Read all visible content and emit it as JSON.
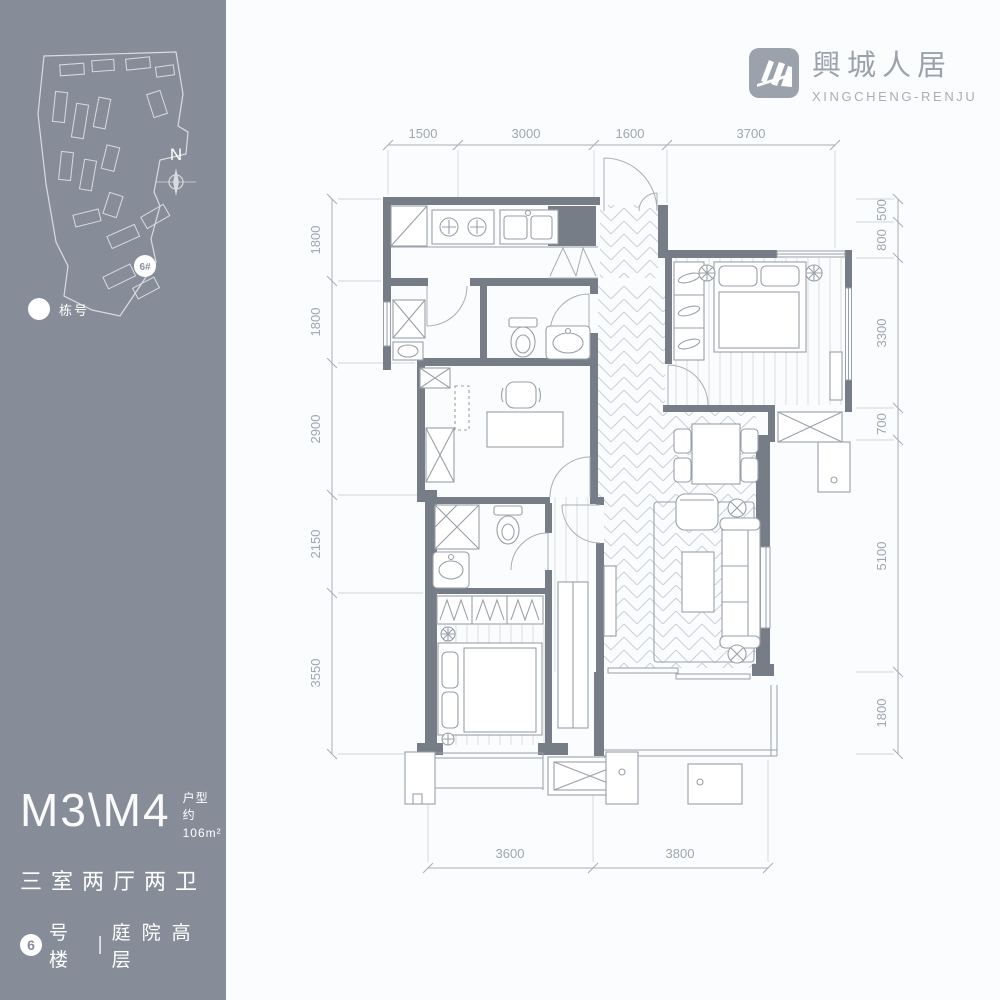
{
  "brand": {
    "cn": "興城人居",
    "en": "XINGCHENG-RENJU"
  },
  "sidebar": {
    "compass": "N",
    "marker": "6#",
    "legend": "栋号"
  },
  "unit": {
    "code": "M3\\M4",
    "type_label": "户型",
    "area": "约106m²",
    "rooms": "三室两厅两卫",
    "badge": "6",
    "building": "号楼",
    "divider": "|",
    "feature": "庭院高层"
  },
  "dims": {
    "top": [
      "1500",
      "3000",
      "1600",
      "3700"
    ],
    "left": [
      "1800",
      "1800",
      "2900",
      "2150",
      "3550"
    ],
    "right": [
      "500",
      "800",
      "3300",
      "700",
      "5100",
      "1800"
    ],
    "bottom": [
      "3600",
      "3800"
    ]
  },
  "colors": {
    "panel": "#868D99",
    "wall": "#767D86",
    "line": "#9FA6AE",
    "floor_pattern": "#CBD0D6"
  }
}
